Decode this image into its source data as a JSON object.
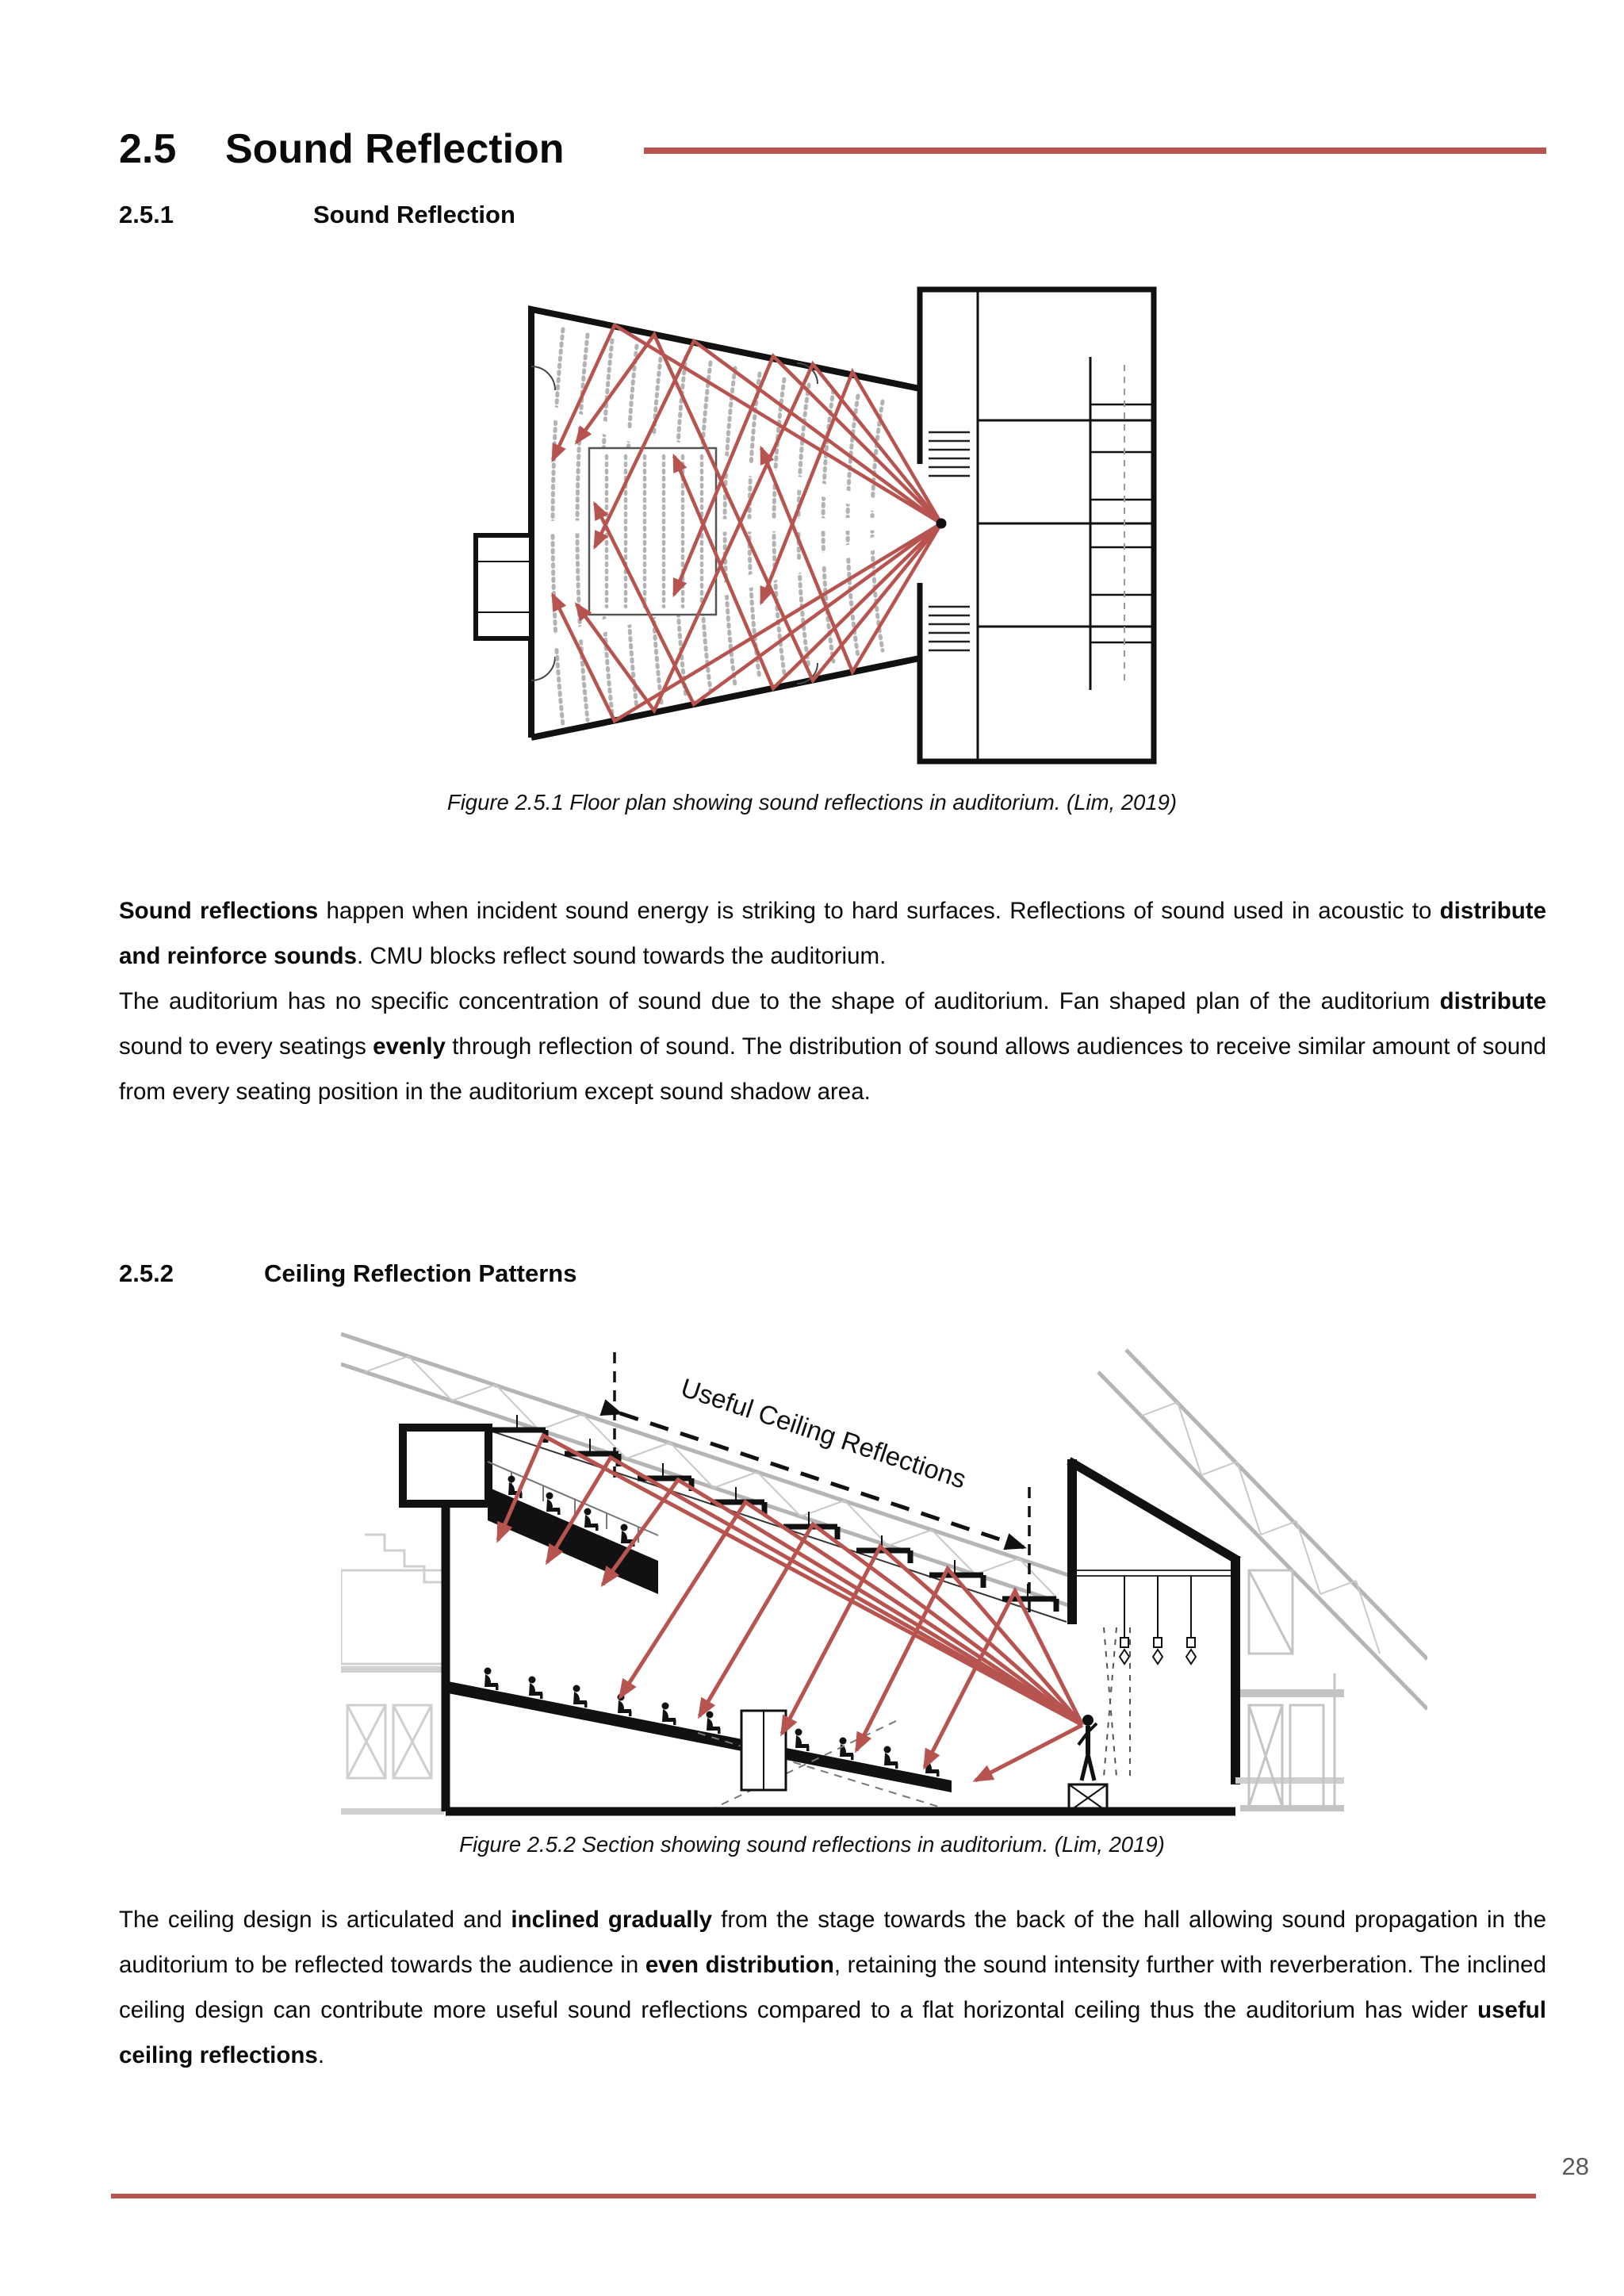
{
  "accent_color": "#b85450",
  "header": {
    "section_number": "2.5",
    "section_title": "Sound Reflection"
  },
  "subsection1": {
    "number": "2.5.1",
    "title": "Sound Reflection"
  },
  "subsection2": {
    "number": "2.5.2",
    "title": "Ceiling Reflection Patterns"
  },
  "figure1": {
    "caption": "Figure 2.5.1 Floor plan showing sound reflections in auditorium. (Lim, 2019)"
  },
  "figure2": {
    "annotation": "Useful Ceiling Reflections",
    "caption": "Figure 2.5.2 Section showing sound reflections in auditorium. (Lim, 2019)"
  },
  "paragraphs": {
    "p1": {
      "segments": [
        {
          "t": "Sound reflections",
          "b": true
        },
        {
          "t": " happen when incident sound energy is striking to hard surfaces. Reflections of sound used in acoustic to ",
          "b": false
        },
        {
          "t": "distribute and reinforce sounds",
          "b": true
        },
        {
          "t": ". CMU blocks reflect sound towards the auditorium.",
          "b": false
        }
      ]
    },
    "p2": {
      "segments": [
        {
          "t": "The auditorium has no specific concentration of sound due to the shape of auditorium. Fan shaped plan of the auditorium ",
          "b": false
        },
        {
          "t": "distribute",
          "b": true
        },
        {
          "t": " sound to every seatings ",
          "b": false
        },
        {
          "t": "evenly",
          "b": true
        },
        {
          "t": " through reflection of sound. The distribution of sound allows audiences to receive similar amount of sound from every seating position in the auditorium except sound shadow area.",
          "b": false
        }
      ]
    },
    "p3": {
      "segments": [
        {
          "t": "The ceiling design is articulated and ",
          "b": false
        },
        {
          "t": "inclined gradually",
          "b": true
        },
        {
          "t": " from the stage towards the back of the hall allowing sound propagation in the auditorium to be reflected towards the audience in ",
          "b": false
        },
        {
          "t": "even distribution",
          "b": true
        },
        {
          "t": ", retaining the sound intensity further with reverberation. The inclined ceiling design can contribute more useful sound reflections compared to a flat horizontal ceiling thus the auditorium has wider ",
          "b": false
        },
        {
          "t": "useful ceiling reflections",
          "b": true
        },
        {
          "t": ".",
          "b": false
        }
      ]
    }
  },
  "footer": {
    "page_number": "28"
  }
}
